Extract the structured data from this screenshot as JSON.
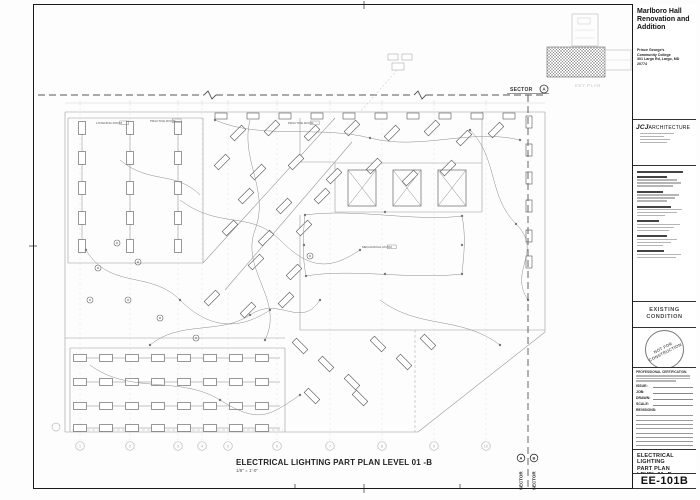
{
  "sheet": {
    "project": {
      "title_lines": [
        "Marlboro Hall",
        "Renovation and",
        "Addition"
      ],
      "client_lines": [
        "Prince George's",
        "Community College",
        "301 Largo Rd, Largo, MD",
        "20774"
      ]
    },
    "architect": {
      "logo_bold": "JCJ",
      "logo_rest": "ARCHITECTURE"
    },
    "status": {
      "line1": "EXISTING",
      "line2": "CONDITION"
    },
    "stamp": {
      "line1": "NOT FOR",
      "line2": "CONSTRUCTION"
    },
    "cert_heading": "PROFESSIONAL CERTIFICATION.",
    "fields": {
      "issue": "ISSUE:",
      "job": "JOB:",
      "drawn": "DRAWN:",
      "scale": "SCALE:",
      "revisions": "REVISIONS:"
    },
    "title_lines": [
      "ELECTRICAL",
      "LIGHTING",
      "PART PLAN",
      "LEVEL 01 -B"
    ],
    "number": "EE-101B",
    "key_plan_label": "KEY PLAN"
  },
  "view": {
    "title": "ELECTRICAL LIGHTING  PART PLAN LEVEL 01 -B",
    "scale": "1/8\" = 1'-0\"",
    "sector_top": {
      "label": "SECTOR",
      "letter": "A"
    },
    "sector_bottom": [
      {
        "label": "SECTOR",
        "letter": "A"
      },
      {
        "label": "SECTOR",
        "letter": "B"
      }
    ]
  },
  "plan": {
    "grid": {
      "xs": [
        80,
        130,
        178,
        202,
        228,
        277,
        330,
        382,
        434,
        486
      ],
      "labels": [
        "1",
        "2",
        "3",
        "4",
        "5",
        "6",
        "7",
        "8",
        "9",
        "10"
      ],
      "bubble_y": 446,
      "top_y": 108,
      "side_bubble": [
        56,
        427
      ]
    },
    "walls": [
      [
        65,
        112,
        545,
        112
      ],
      [
        545,
        112,
        545,
        332
      ],
      [
        65,
        112,
        65,
        432
      ],
      [
        65,
        432,
        418,
        432
      ],
      [
        418,
        432,
        545,
        332
      ],
      [
        68,
        118,
        203,
        118
      ],
      [
        203,
        118,
        203,
        263
      ],
      [
        68,
        263,
        203,
        263
      ],
      [
        68,
        118,
        68,
        263
      ],
      [
        70,
        348,
        285,
        348
      ],
      [
        285,
        348,
        285,
        432
      ],
      [
        70,
        348,
        70,
        432
      ],
      [
        300,
        118,
        300,
        162
      ],
      [
        300,
        162,
        335,
        162
      ],
      [
        335,
        163,
        482,
        163
      ],
      [
        335,
        163,
        335,
        212
      ],
      [
        482,
        163,
        482,
        212
      ],
      [
        335,
        212,
        482,
        212
      ],
      [
        482,
        112,
        482,
        163
      ],
      [
        203,
        263,
        335,
        118
      ],
      [
        225,
        290,
        352,
        142
      ],
      [
        300,
        215,
        300,
        330
      ],
      [
        300,
        330,
        545,
        330
      ],
      [
        65,
        338,
        285,
        338
      ]
    ],
    "dash_walls": [
      [
        415,
        330,
        415,
        432
      ],
      [
        72,
        430,
        283,
        430
      ]
    ],
    "fix_v": {
      "cols": [
        82,
        130,
        178
      ],
      "rows": [
        128,
        158,
        188,
        218,
        246
      ],
      "w": 7,
      "h": 13
    },
    "fix_h": {
      "rows": [
        358,
        382,
        406,
        428
      ],
      "cols": [
        80,
        106,
        132,
        158,
        184,
        210,
        236,
        262
      ],
      "w": 13,
      "h": 7
    },
    "fix_row_top": {
      "y": 116,
      "xs": [
        215,
        247,
        279,
        311,
        343,
        375,
        407,
        439,
        471,
        503
      ],
      "w": 12,
      "h": 6
    },
    "fix_right": {
      "x": 529,
      "ys": [
        122,
        150,
        178,
        206,
        236,
        262
      ],
      "w": 6,
      "h": 12
    },
    "fix_diag": [
      [
        238,
        133,
        -45
      ],
      [
        272,
        128,
        -45
      ],
      [
        312,
        133,
        -45
      ],
      [
        352,
        128,
        -45
      ],
      [
        392,
        133,
        -45
      ],
      [
        432,
        128,
        -45
      ],
      [
        464,
        138,
        -45
      ],
      [
        496,
        130,
        -45
      ],
      [
        222,
        162,
        -45
      ],
      [
        258,
        172,
        -45
      ],
      [
        296,
        162,
        -45
      ],
      [
        334,
        176,
        -45
      ],
      [
        374,
        166,
        -45
      ],
      [
        410,
        178,
        -45
      ],
      [
        448,
        168,
        -45
      ],
      [
        246,
        196,
        -45
      ],
      [
        284,
        206,
        -45
      ],
      [
        322,
        196,
        -45
      ],
      [
        230,
        228,
        -45
      ],
      [
        266,
        238,
        -45
      ],
      [
        304,
        228,
        -45
      ],
      [
        256,
        262,
        -45
      ],
      [
        294,
        272,
        -45
      ],
      [
        212,
        298,
        -45
      ],
      [
        248,
        310,
        -45
      ],
      [
        286,
        300,
        -45
      ],
      [
        300,
        346,
        45
      ],
      [
        326,
        364,
        45
      ],
      [
        352,
        382,
        45
      ],
      [
        378,
        344,
        45
      ],
      [
        404,
        362,
        45
      ],
      [
        428,
        342,
        45
      ],
      [
        312,
        396,
        45
      ],
      [
        360,
        398,
        45
      ]
    ],
    "hatch_boxes": [
      [
        348,
        170,
        28,
        36
      ],
      [
        393,
        170,
        28,
        36
      ],
      [
        438,
        170,
        28,
        36
      ]
    ],
    "circles": [
      [
        117,
        243
      ],
      [
        98,
        268
      ],
      [
        138,
        262
      ],
      [
        90,
        300
      ],
      [
        128,
        300
      ],
      [
        160,
        318
      ],
      [
        196,
        338
      ],
      [
        310,
        256
      ]
    ],
    "circuits": [
      "M215,120 C260,140 320,125 370,138 S470,128 520,140",
      "M86,250 C110,290 150,270 180,300 S240,330 270,310",
      "M180,200 C220,230 250,210 280,240 S330,270 360,250",
      "M305,215 C355,208 415,222 462,216",
      "M462,216 C466,236 464,254 462,274",
      "M462,274 C410,280 352,268 306,276",
      "M306,276 C302,256 303,234 305,215",
      "M150,345 C180,320 220,335 250,315 S300,330 320,300",
      "M90,365 C130,395 180,375 220,400 S270,415 300,395",
      "M470,130 C498,158 488,196 516,224 S508,270 528,300",
      "M250,120 C240,160 270,190 255,230 S285,300 265,340",
      "M380,300 C420,330 460,315 500,345",
      "M120,160 C150,185 175,170 200,195"
    ],
    "nodes": [
      [
        305,
        215
      ],
      [
        385,
        212
      ],
      [
        462,
        216
      ],
      [
        462,
        245
      ],
      [
        462,
        274
      ],
      [
        385,
        274
      ],
      [
        306,
        276
      ],
      [
        304,
        245
      ],
      [
        215,
        120
      ],
      [
        370,
        138
      ],
      [
        520,
        140
      ],
      [
        180,
        300
      ],
      [
        270,
        310
      ],
      [
        360,
        250
      ],
      [
        320,
        300
      ],
      [
        300,
        395
      ],
      [
        528,
        300
      ],
      [
        265,
        340
      ],
      [
        500,
        345
      ],
      [
        250,
        315
      ],
      [
        220,
        400
      ],
      [
        86,
        250
      ],
      [
        150,
        345
      ],
      [
        470,
        130
      ],
      [
        516,
        224
      ]
    ],
    "room_labels": [
      {
        "t": "LISTENING ROOM",
        "x": 96,
        "y": 124
      },
      {
        "t": "PRACTICE ROOM",
        "x": 150,
        "y": 122
      },
      {
        "t": "PRACTICE ROOM",
        "x": 288,
        "y": 124
      },
      {
        "t": "MECHANICAL ROOM",
        "x": 362,
        "y": 248
      }
    ],
    "match_top": {
      "y": 95,
      "x1": 38,
      "x2": 545,
      "breaks": [
        210,
        420
      ]
    },
    "match_right": {
      "x": 528,
      "y1": 95,
      "y2": 488
    },
    "keyplan": {
      "upper": [
        572,
        14,
        26,
        32
      ],
      "hatch": [
        547,
        47,
        58,
        30
      ],
      "wing": [
        605,
        50,
        26,
        20
      ],
      "label_xy": [
        575,
        87
      ]
    },
    "cluster": {
      "rects": [
        [
          388,
          54,
          10,
          6
        ],
        [
          402,
          54,
          10,
          6
        ],
        [
          392,
          63,
          12,
          7
        ]
      ],
      "leader": [
        397,
        70,
        360,
        112
      ]
    },
    "sector_top_xy": [
      510,
      91
    ],
    "sector_bottom_xs": [
      521,
      534
    ],
    "sector_bottom_base": 490,
    "ticks": [
      [
        295,
        484,
        295,
        489
      ],
      [
        460,
        484,
        460,
        489
      ],
      [
        364,
        1,
        364,
        9
      ],
      [
        29,
        246,
        37,
        246
      ],
      [
        364,
        484,
        364,
        493
      ]
    ]
  }
}
